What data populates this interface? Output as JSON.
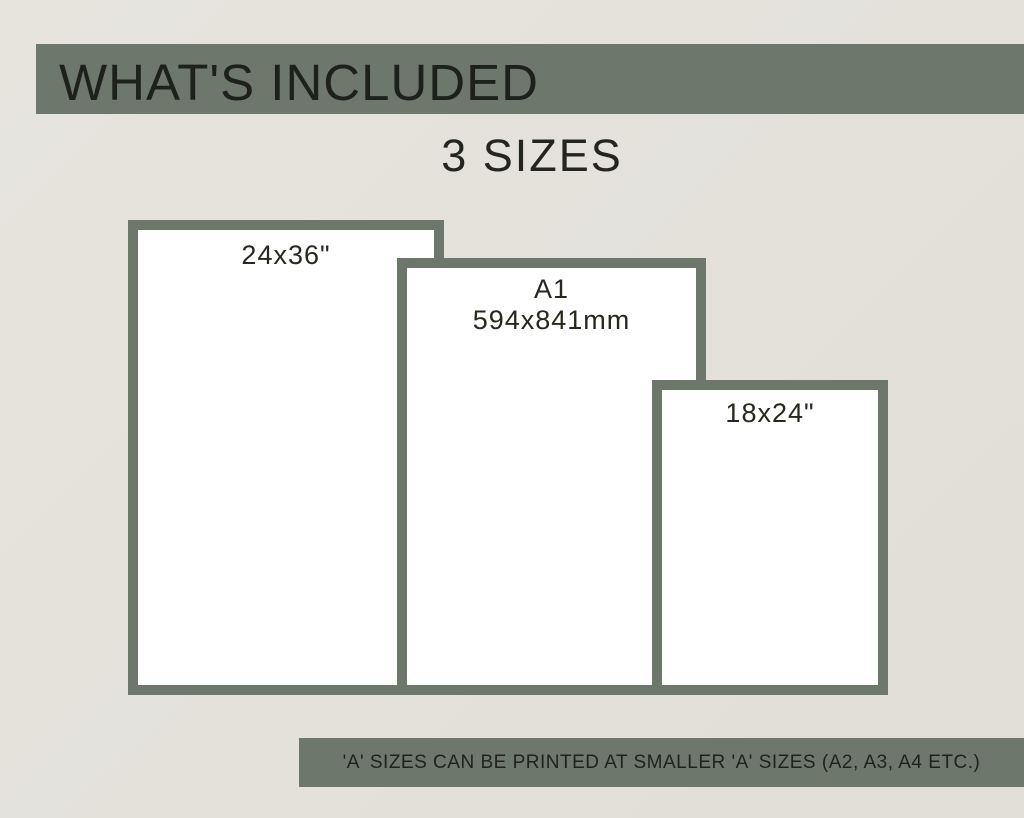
{
  "header": {
    "title": "WHAT'S INCLUDED",
    "subtitle": "3 SIZES"
  },
  "sizes": [
    {
      "label_lines": [
        "24x36\""
      ]
    },
    {
      "label_lines": [
        "A1",
        "594x841mm"
      ]
    },
    {
      "label_lines": [
        "18x24\""
      ]
    }
  ],
  "footnote": {
    "text": "'A' SIZES CAN BE PRINTED AT SMALLER 'A' SIZES (A2, A3, A4 ETC.)"
  },
  "colors": {
    "accent_green": "#6e776c",
    "background": "#e5e2dc",
    "frame_fill": "#ffffff",
    "text_dark": "#23261f"
  }
}
